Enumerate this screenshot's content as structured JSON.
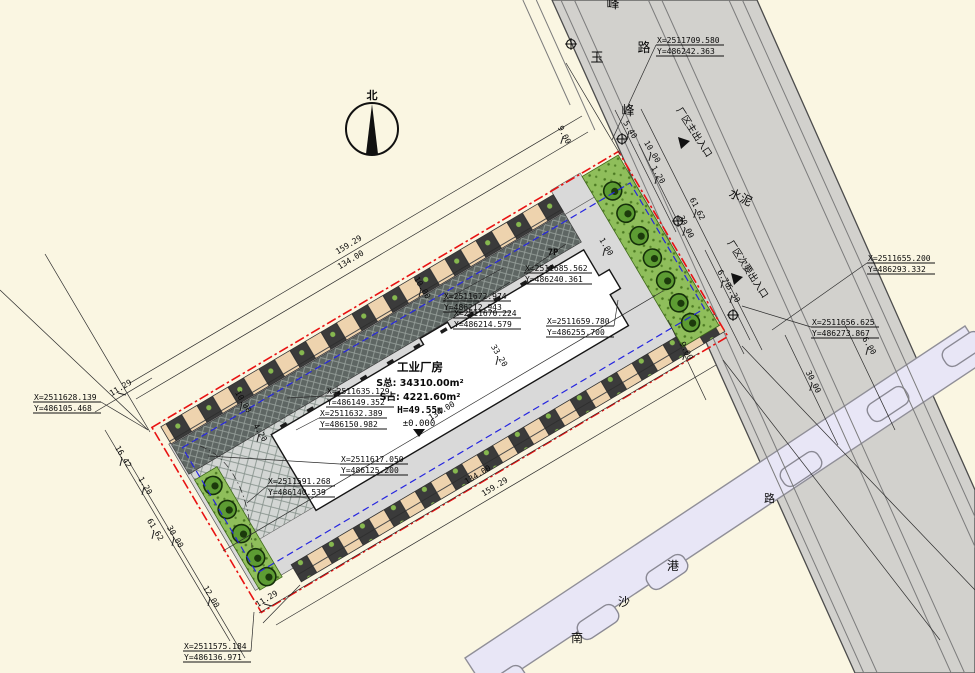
{
  "drawing": {
    "north_label": "北",
    "building": {
      "name": "工业厂房",
      "area_total": "S总: 34310.00m²",
      "area_footprint": "S占: 4221.60m²",
      "height": "H=49.55m",
      "level": "±0.000",
      "p_label": "7P"
    },
    "roads": {
      "name_chars": [
        "玉",
        "峰",
        "路",
        "峰"
      ],
      "surface_label": "水泥",
      "main_entrance": "厂区主出入口",
      "secondary_entrance": "厂区次要出入口",
      "waterway_chars": [
        "南",
        "沙",
        "港"
      ],
      "crossing_road_char": "路"
    },
    "coordinates": [
      {
        "x": "X=2511709.580",
        "y": "Y=486242.363"
      },
      {
        "x": "X=2511685.562",
        "y": "Y=486240.361"
      },
      {
        "x": "X=2511672.974",
        "y": "Y=486212.943"
      },
      {
        "x": "X=2511670.224",
        "y": "Y=486214.579"
      },
      {
        "x": "X=2511659.780",
        "y": "Y=486255.700"
      },
      {
        "x": "X=2511655.200",
        "y": "Y=486293.332"
      },
      {
        "x": "X=2511656.625",
        "y": "Y=486273.867"
      },
      {
        "x": "X=2511635.129",
        "y": "Y=486149.352"
      },
      {
        "x": "X=2511632.389",
        "y": "Y=486150.982"
      },
      {
        "x": "X=2511628.139",
        "y": "Y=486105.468"
      },
      {
        "x": "X=2511617.050",
        "y": "Y=486125.200"
      },
      {
        "x": "X=2511591.268",
        "y": "Y=486140.539"
      },
      {
        "x": "X=2511575.184",
        "y": "Y=486136.971"
      }
    ],
    "dimensions": [
      "159.29",
      "134.00",
      "11.29",
      "16.42",
      "1.20",
      "61.62",
      "30.00",
      "12.00",
      "11.29",
      "134.00",
      "134.00",
      "159.29",
      "33.20",
      "4.20",
      "10.00",
      "10.00",
      "1.00",
      "5.40",
      "10.00",
      "1.20",
      "61.62",
      "30.00",
      "6.70",
      "5.30",
      "9.00",
      "30.00",
      "6.00",
      "9.00"
    ]
  }
}
